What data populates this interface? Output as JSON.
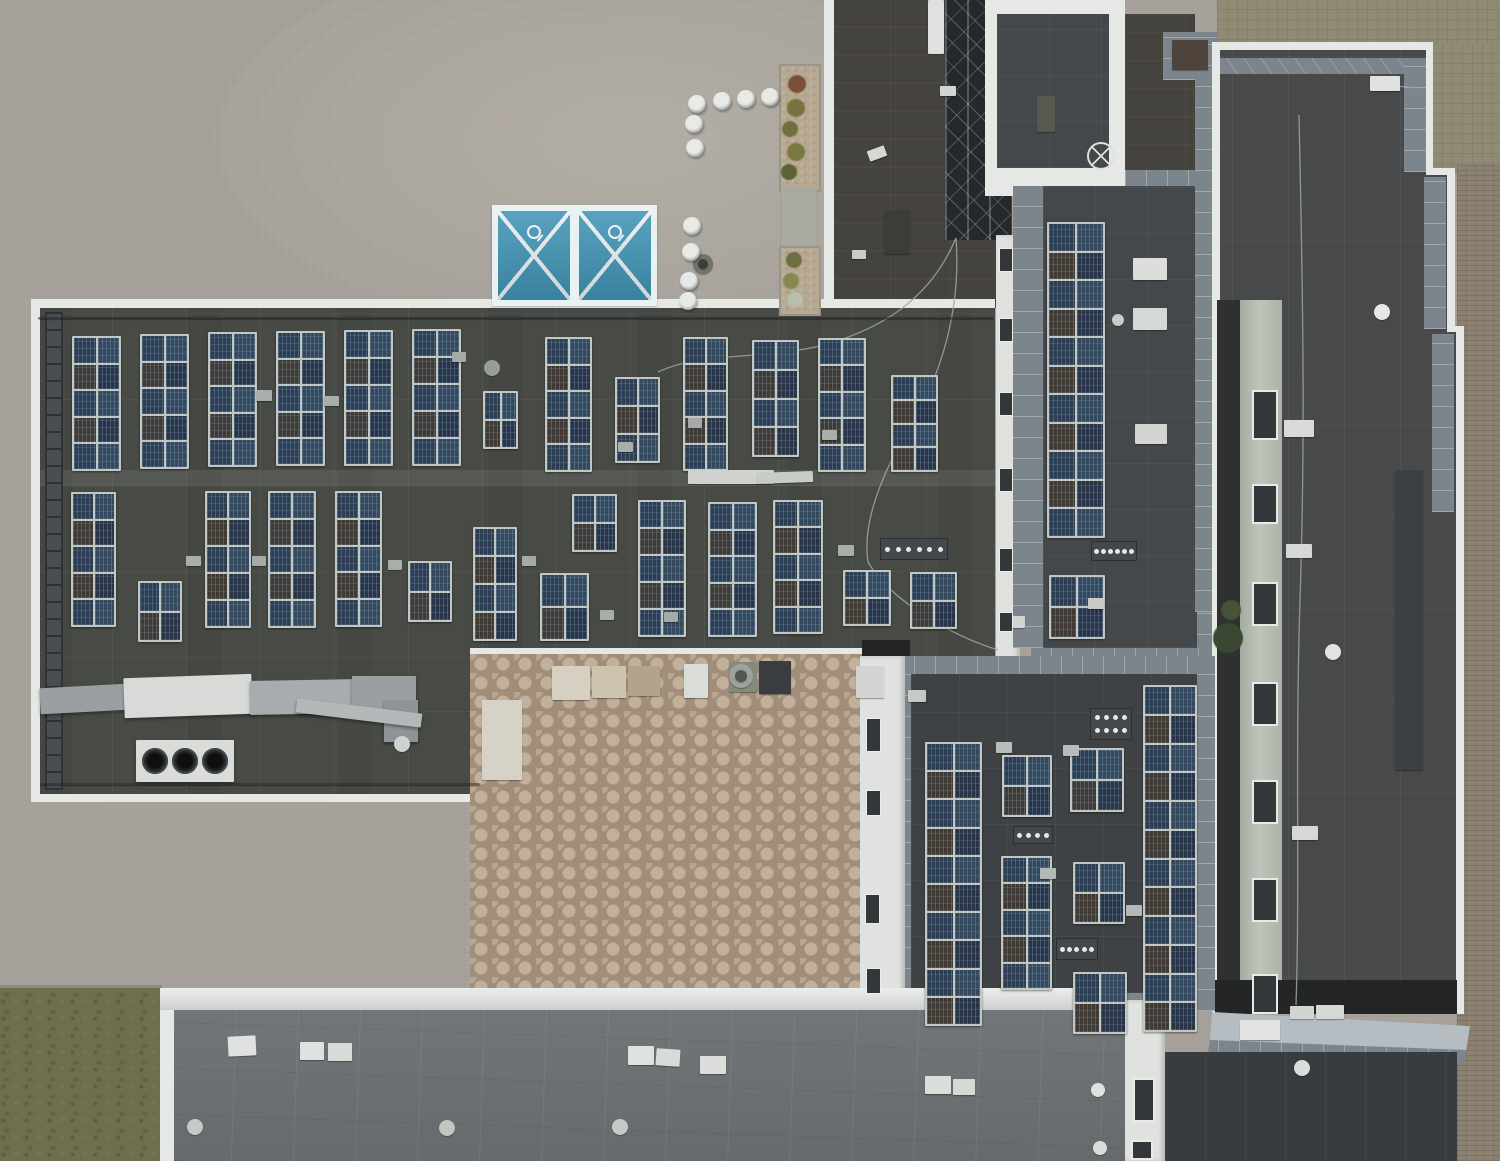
{
  "meta": {
    "title": "Aerial drone view of flat rooftops with solar panel arrays",
    "width": 1500,
    "height": 1161
  },
  "palette": {
    "pavement": "#a7a29b",
    "roof_dark": "#484b45",
    "roof_blue_gray": "#45484b",
    "roof_bottom_building": "#6b7073",
    "parapet_white": "#e6e8e6",
    "slab_border": "#7d858c",
    "courtyard_pavers": "#b9a68f",
    "sports_court_blue": "#3e93b5",
    "grass": "#6d6f4e",
    "solar_panel_blue": "#2c3e53",
    "solar_frame": "#c3c7c3",
    "brick_band": "#8c8171"
  },
  "scene": {
    "solar_arrays": [
      [
        72,
        336,
        45,
        131,
        2,
        5
      ],
      [
        140,
        334,
        45,
        131,
        2,
        5
      ],
      [
        208,
        332,
        45,
        131,
        2,
        5
      ],
      [
        276,
        331,
        45,
        131,
        2,
        5
      ],
      [
        344,
        330,
        45,
        132,
        2,
        5
      ],
      [
        412,
        329,
        45,
        133,
        2,
        5
      ],
      [
        483,
        391,
        31,
        54,
        2,
        2
      ],
      [
        545,
        337,
        43,
        131,
        2,
        5
      ],
      [
        615,
        377,
        41,
        82,
        2,
        3
      ],
      [
        683,
        337,
        41,
        130,
        2,
        5
      ],
      [
        752,
        340,
        43,
        113,
        2,
        4
      ],
      [
        818,
        338,
        44,
        130,
        2,
        5
      ],
      [
        891,
        375,
        43,
        93,
        2,
        4
      ],
      [
        71,
        492,
        41,
        131,
        2,
        5
      ],
      [
        138,
        581,
        40,
        57,
        2,
        2
      ],
      [
        205,
        491,
        42,
        133,
        2,
        5
      ],
      [
        268,
        491,
        44,
        133,
        2,
        5
      ],
      [
        335,
        491,
        43,
        132,
        2,
        5
      ],
      [
        408,
        561,
        40,
        57,
        2,
        2
      ],
      [
        473,
        527,
        40,
        110,
        2,
        4
      ],
      [
        540,
        573,
        45,
        64,
        2,
        2
      ],
      [
        572,
        494,
        41,
        54,
        2,
        2
      ],
      [
        638,
        500,
        44,
        133,
        2,
        5
      ],
      [
        708,
        502,
        45,
        131,
        2,
        5
      ],
      [
        773,
        500,
        46,
        130,
        2,
        5
      ],
      [
        843,
        570,
        44,
        52,
        2,
        2
      ],
      [
        910,
        572,
        43,
        53,
        2,
        2
      ],
      [
        1047,
        222,
        54,
        312,
        2,
        11
      ],
      [
        1049,
        575,
        52,
        60,
        2,
        2
      ],
      [
        925,
        742,
        53,
        280,
        2,
        10
      ],
      [
        1002,
        755,
        46,
        58,
        2,
        2
      ],
      [
        1070,
        748,
        50,
        60,
        2,
        2
      ],
      [
        1143,
        685,
        50,
        343,
        2,
        12
      ],
      [
        1001,
        856,
        47,
        130,
        2,
        5
      ],
      [
        1073,
        862,
        48,
        58,
        2,
        2
      ],
      [
        1073,
        972,
        50,
        58,
        2,
        2
      ]
    ],
    "boxes": [
      [
        38,
        317,
        956,
        2,
        "rgba(35,38,40,0.55)",
        0
      ],
      [
        40,
        783,
        440,
        2,
        "rgba(35,38,40,0.45)",
        0
      ],
      [
        1133,
        258,
        34,
        22,
        "#dcdedb",
        0
      ],
      [
        1133,
        308,
        34,
        22,
        "#d6d8d5",
        0
      ],
      [
        1135,
        424,
        32,
        20,
        "#d2d5d2",
        0
      ],
      [
        688,
        470,
        86,
        14,
        "#cfd2cf",
        0
      ],
      [
        757,
        472,
        56,
        11,
        "#c8ccc9",
        -2
      ],
      [
        552,
        666,
        38,
        34,
        "#d6d0c2",
        0
      ],
      [
        592,
        666,
        34,
        32,
        "#cec3ad",
        0
      ],
      [
        628,
        666,
        32,
        30,
        "#b1a38c",
        0
      ],
      [
        684,
        664,
        24,
        34,
        "#dadcd7",
        0
      ],
      [
        729,
        662,
        28,
        30,
        "#87897d",
        0
      ],
      [
        759,
        661,
        32,
        33,
        "#3a3d3f",
        0
      ],
      [
        856,
        666,
        28,
        32,
        "#d2d5d2",
        0
      ],
      [
        482,
        700,
        40,
        80,
        "#d7d2c8",
        0
      ],
      [
        228,
        1036,
        28,
        20,
        "#dfe1de",
        -3
      ],
      [
        300,
        1042,
        24,
        18,
        "#dfe1de",
        0
      ],
      [
        328,
        1043,
        24,
        18,
        "#d9dbd8",
        0
      ],
      [
        628,
        1046,
        26,
        19,
        "#dfe1de",
        0
      ],
      [
        656,
        1049,
        24,
        17,
        "#d9dbd8",
        4
      ],
      [
        700,
        1056,
        26,
        18,
        "#dcdedb",
        0
      ],
      [
        925,
        1076,
        26,
        18,
        "#dcdedb",
        0
      ],
      [
        953,
        1079,
        22,
        16,
        "#d6d8d5",
        0
      ],
      [
        1284,
        420,
        30,
        17,
        "#d9dbd8",
        0
      ],
      [
        1286,
        544,
        26,
        14,
        "#d6d8d5",
        0
      ],
      [
        1292,
        826,
        26,
        14,
        "#d6d8d5",
        0
      ],
      [
        1240,
        1020,
        40,
        20,
        "#e2e4e1",
        0
      ],
      [
        1290,
        1006,
        24,
        13,
        "#d2d5d2",
        0
      ],
      [
        1316,
        1005,
        28,
        14,
        "#d6d8d5",
        0
      ],
      [
        1370,
        76,
        30,
        15,
        "#e0e2df",
        0
      ],
      [
        1395,
        470,
        28,
        300,
        "#3d4042",
        0
      ],
      [
        1037,
        96,
        18,
        36,
        "#56594f",
        0
      ],
      [
        1172,
        40,
        36,
        30,
        "#4e443c",
        0
      ],
      [
        928,
        0,
        16,
        54,
        "#dfe1de",
        0
      ],
      [
        1005,
        616,
        20,
        12,
        "#d2d5d2",
        0
      ],
      [
        1088,
        598,
        16,
        11,
        "#caccc9",
        0
      ],
      [
        996,
        742,
        16,
        11,
        "#b9bdba",
        0
      ],
      [
        1063,
        745,
        16,
        11,
        "#b9bdba",
        0
      ],
      [
        1040,
        868,
        16,
        11,
        "#b5b9b6",
        0
      ],
      [
        1126,
        905,
        16,
        11,
        "#b5b9b6",
        0
      ],
      [
        908,
        690,
        18,
        12,
        "#c6cac6",
        0
      ],
      [
        256,
        390,
        16,
        11,
        "#a9adab",
        0
      ],
      [
        324,
        396,
        15,
        10,
        "#a9adab",
        0
      ],
      [
        452,
        352,
        14,
        10,
        "#a5a9a7",
        0
      ],
      [
        618,
        442,
        15,
        10,
        "#a9adab",
        0
      ],
      [
        688,
        418,
        14,
        10,
        "#a5a9a7",
        0
      ],
      [
        822,
        430,
        15,
        10,
        "#a9adab",
        0
      ],
      [
        186,
        556,
        15,
        10,
        "#a9adab",
        0
      ],
      [
        252,
        556,
        14,
        10,
        "#a5a9a7",
        0
      ],
      [
        388,
        560,
        14,
        10,
        "#a9adab",
        0
      ],
      [
        522,
        556,
        14,
        10,
        "#a5a9a7",
        0
      ],
      [
        600,
        610,
        14,
        10,
        "#a9adab",
        0
      ],
      [
        664,
        612,
        14,
        10,
        "#a5a9a7",
        0
      ],
      [
        838,
        545,
        16,
        11,
        "#a9adab",
        0
      ],
      [
        868,
        148,
        18,
        11,
        "#d6d8d5",
        -20
      ],
      [
        940,
        86,
        16,
        10,
        "#d2d5d2",
        0
      ],
      [
        852,
        250,
        14,
        9,
        "#caccc9",
        0
      ],
      [
        884,
        210,
        26,
        44,
        "#3e3c36",
        0
      ]
    ],
    "round_vents": [
      [
        1382,
        312,
        8,
        "#e6e8e6"
      ],
      [
        1333,
        652,
        8,
        "#e2e4e1"
      ],
      [
        1302,
        1068,
        8,
        "#dcdedb"
      ],
      [
        195,
        1127,
        8,
        "#c6cac6"
      ],
      [
        447,
        1128,
        8,
        "#c2c6c3"
      ],
      [
        620,
        1127,
        8,
        "#c6cac6"
      ],
      [
        1098,
        1090,
        7,
        "#dfe1de"
      ],
      [
        1100,
        1148,
        7,
        "#dcdedb"
      ],
      [
        402,
        744,
        8,
        "#cfd2cf"
      ],
      [
        1118,
        320,
        6,
        "#caccc9"
      ],
      [
        492,
        368,
        8,
        "#989c9a"
      ],
      [
        741,
        676,
        12,
        "#9da39b"
      ],
      [
        741,
        676,
        6,
        "#54584e"
      ],
      [
        703,
        264,
        10,
        "#72746c"
      ],
      [
        703,
        264,
        5,
        "#3c3e38"
      ]
    ],
    "manifolds": [
      [
        1091,
        541,
        40,
        14,
        6,
        1
      ],
      [
        1090,
        708,
        36,
        26,
        4,
        2
      ],
      [
        1013,
        826,
        34,
        12,
        4,
        1
      ],
      [
        1056,
        938,
        36,
        16,
        5,
        1
      ],
      [
        880,
        538,
        62,
        16,
        6,
        1
      ]
    ],
    "bollard_radius": 9,
    "bollards": [
      [
        697,
        104
      ],
      [
        722,
        101
      ],
      [
        746,
        99
      ],
      [
        770,
        97
      ],
      [
        694,
        124
      ],
      [
        695,
        148
      ],
      [
        692,
        226
      ],
      [
        691,
        252
      ],
      [
        689,
        281
      ],
      [
        688,
        301
      ]
    ],
    "shrubs": [
      [
        797,
        84,
        9,
        "#7a5038"
      ],
      [
        796,
        108,
        9,
        "#76743e"
      ],
      [
        790,
        129,
        8,
        "#6e6f3f"
      ],
      [
        796,
        152,
        9,
        "#7a7941"
      ],
      [
        789,
        172,
        8,
        "#5d6237"
      ],
      [
        794,
        260,
        8,
        "#6d6f3f"
      ],
      [
        791,
        281,
        8,
        "#858951"
      ],
      [
        795,
        300,
        8,
        "#b8beac"
      ],
      [
        1228,
        638,
        15,
        "#3a4832"
      ],
      [
        1231,
        610,
        10,
        "#455339"
      ]
    ],
    "windows": {
      "right_facade": [
        [
          1252,
          390,
          26,
          50
        ],
        [
          1252,
          484,
          26,
          40
        ],
        [
          1252,
          582,
          26,
          44
        ],
        [
          1252,
          682,
          26,
          44
        ],
        [
          1252,
          780,
          26,
          44
        ],
        [
          1252,
          878,
          26,
          44
        ],
        [
          1252,
          974,
          26,
          40
        ]
      ],
      "mid_wall": [
        [
          999,
          248,
          14,
          24
        ],
        [
          999,
          318,
          14,
          24
        ],
        [
          999,
          392,
          14,
          24
        ],
        [
          999,
          468,
          14,
          24
        ],
        [
          999,
          548,
          14,
          24
        ],
        [
          999,
          612,
          14,
          20
        ]
      ],
      "left_wall": [
        [
          866,
          718,
          15,
          34
        ],
        [
          866,
          790,
          15,
          26
        ],
        [
          865,
          894,
          15,
          30
        ],
        [
          866,
          968,
          15,
          26
        ]
      ],
      "bottom_wall": [
        [
          1133,
          1078,
          22,
          44
        ],
        [
          1131,
          1140,
          22,
          20
        ]
      ]
    },
    "window_slim": [
      "mid_wall",
      "left_wall"
    ],
    "cables": [
      "M956,238 C930,300 880,330 820,346 C758,360 700,352 658,372",
      "M956,238 C962,320 935,390 902,440 C880,480 862,525 868,562",
      "M1299,115 C1302,260 1306,420 1300,600 C1295,760 1300,880 1296,1005",
      "M1373,84 L1418,88",
      "M868,562 C890,600 950,635 998,650"
    ]
  }
}
